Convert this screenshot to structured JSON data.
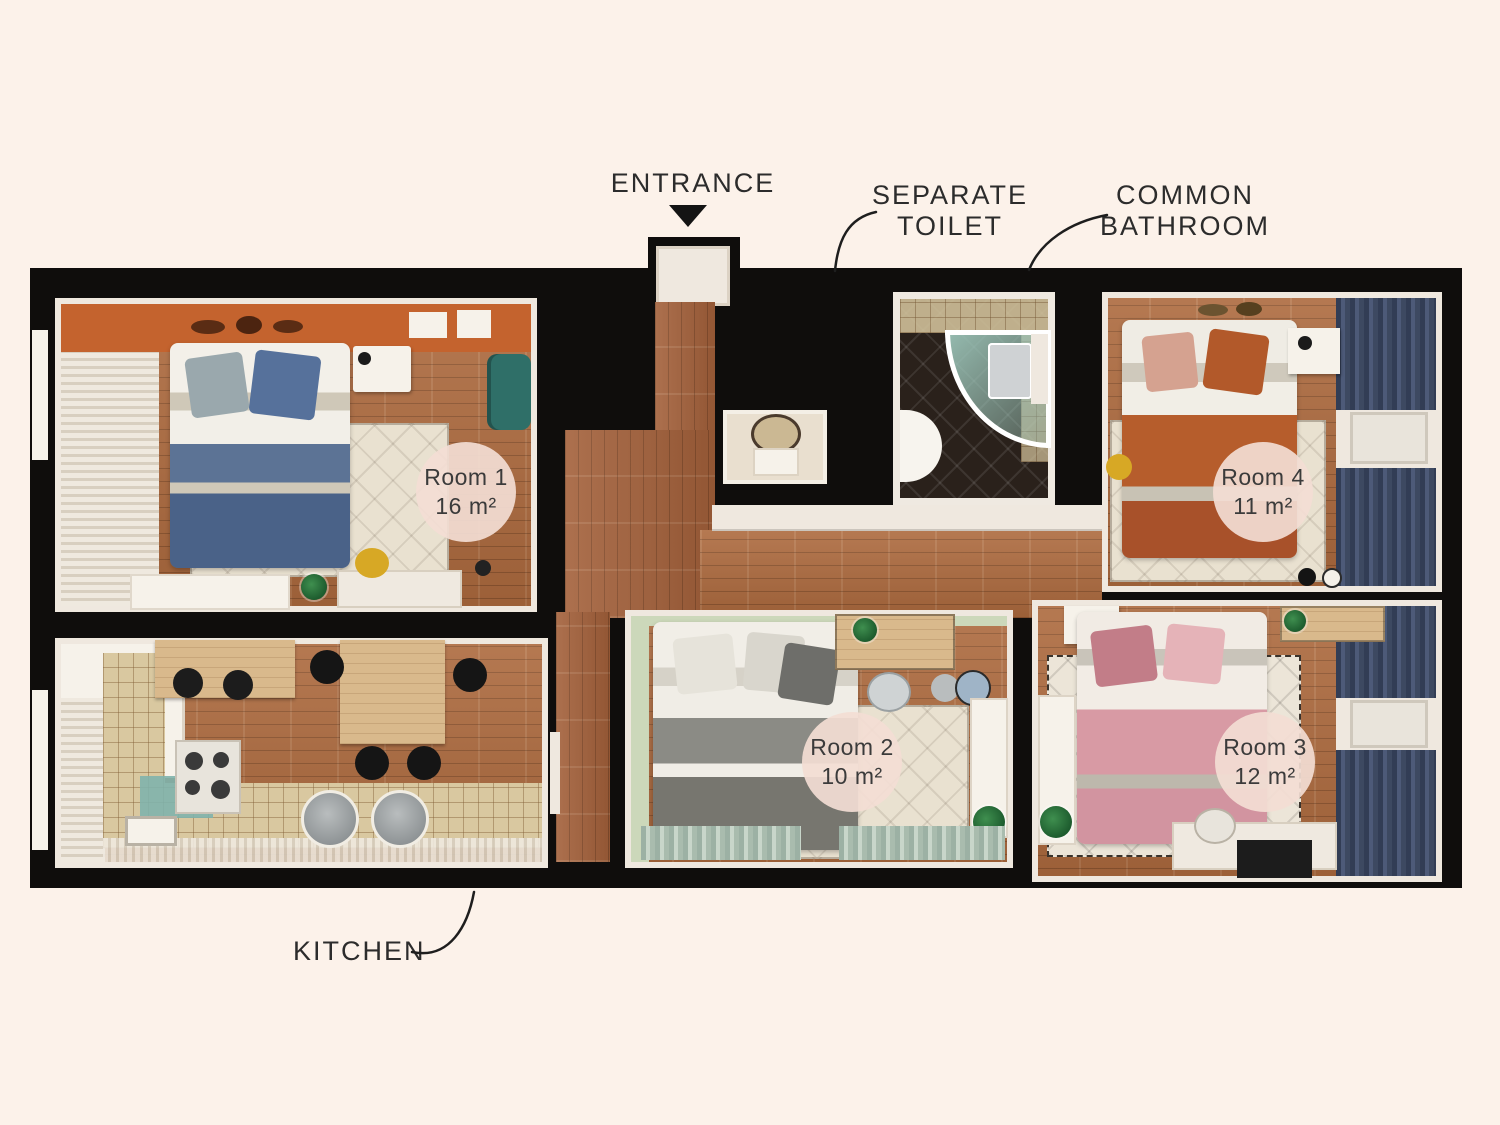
{
  "title": "Apartment floor plan — 4 rooms",
  "palette": {
    "bg": "#fcf2ea",
    "wall": "#0f0d0c",
    "cream": "#efe8df",
    "wood": "#ad6a3e",
    "wood_hall": "#a3603a",
    "wood_light": "#d9b98c",
    "orange_wall": "#c4632e",
    "teal": "#2f6f68",
    "teal_glass": "#9fc9bd",
    "navy": "#3d4961",
    "green_wall": "#ccd8ba",
    "sage": "#a9bcae",
    "pink": "#d89aa4",
    "rust": "#b2592a",
    "blue": "#56719b",
    "gray_bed": "#8b8b85",
    "tile": "#d9c8a0",
    "bath_floor": "#2a211b",
    "yellow": "#d7a825",
    "label_circle": "#f4ded5",
    "text": "#2c2c2c",
    "leader": "#1e1e1e"
  },
  "annotations": {
    "entrance": {
      "label": "ENTRANCE"
    },
    "separate_toilet": {
      "line1": "SEPARATE",
      "line2": "TOILET"
    },
    "common_bathroom": {
      "line1": "COMMON",
      "line2": "BATHROOM"
    },
    "kitchen": {
      "label": "KITCHEN"
    }
  },
  "rooms": [
    {
      "id": "room-1",
      "name": "Room 1",
      "area": "16 m²"
    },
    {
      "id": "room-2",
      "name": "Room 2",
      "area": "10 m²"
    },
    {
      "id": "room-3",
      "name": "Room 3",
      "area": "12 m²"
    },
    {
      "id": "room-4",
      "name": "Room 4",
      "area": "11 m²"
    }
  ]
}
